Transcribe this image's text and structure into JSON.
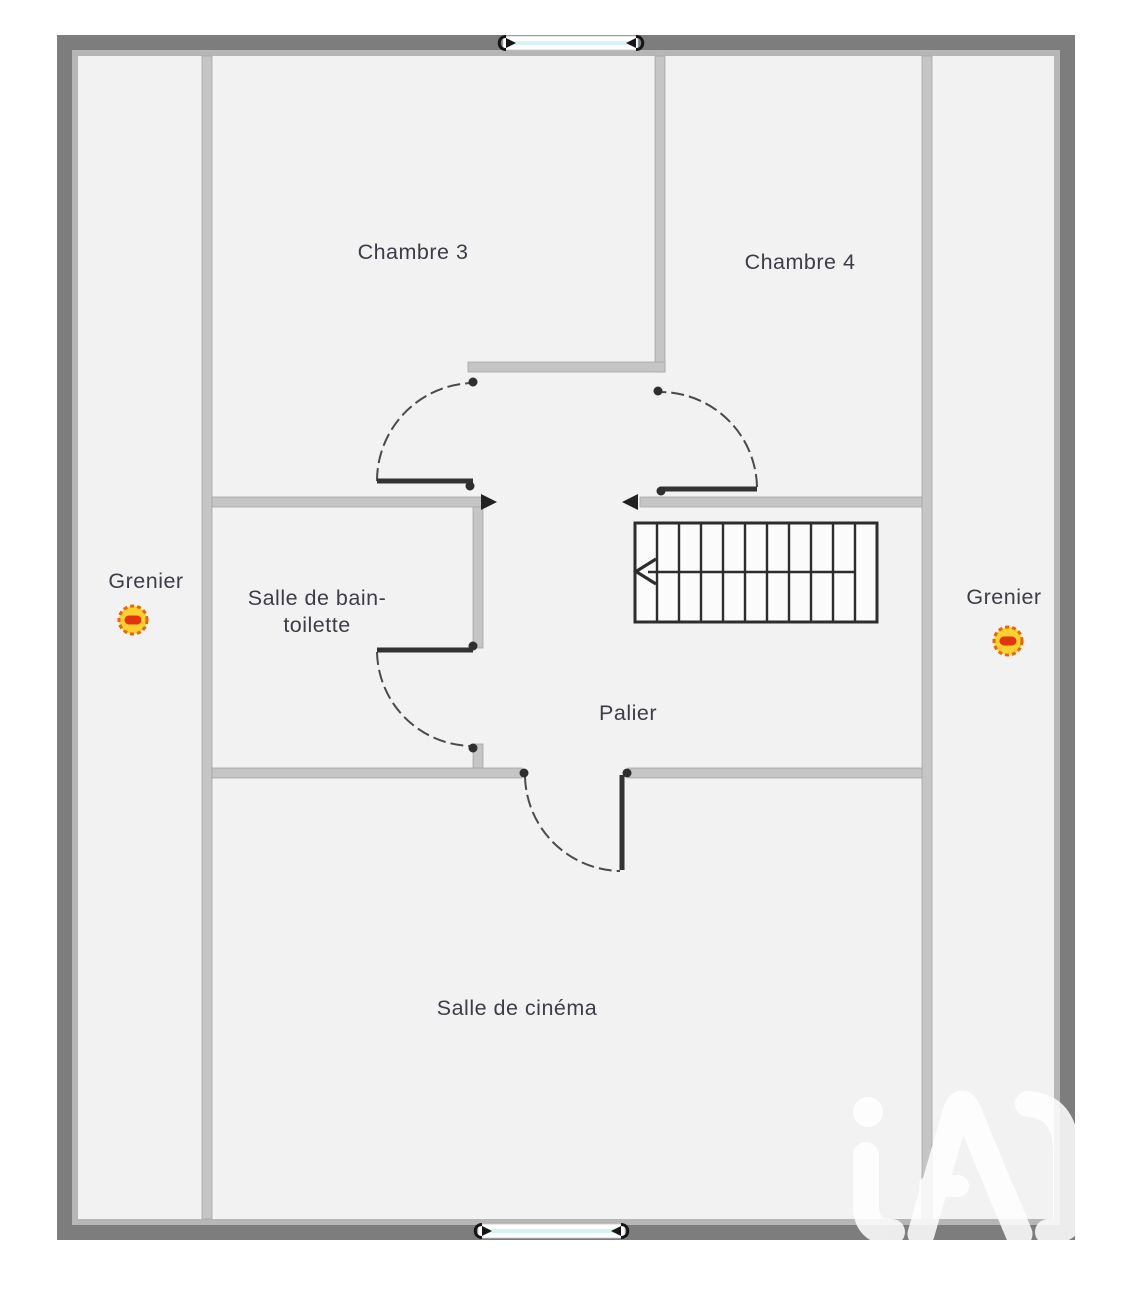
{
  "plan": {
    "title": "Floor plan - upper level",
    "rooms": [
      {
        "id": "chambre3",
        "label": "Chambre 3"
      },
      {
        "id": "chambre4",
        "label": "Chambre 4"
      },
      {
        "id": "bathroom",
        "label_line1": "Salle de bain-",
        "label_line2": "toilette"
      },
      {
        "id": "palier",
        "label": "Palier"
      },
      {
        "id": "cinema",
        "label": "Salle de cinéma"
      },
      {
        "id": "grenier_left",
        "label": "Grenier"
      },
      {
        "id": "grenier_right",
        "label": "Grenier"
      }
    ],
    "icons": [
      {
        "name": "grenier-hatch-icon",
        "count": 2,
        "fill": "#FFD02E",
        "ring": "#E8650A",
        "bar": "#E2350F"
      }
    ],
    "features": {
      "staircase": "stairs with up-direction arrow",
      "windows": 2,
      "doors": 4
    },
    "watermark": {
      "brand": "iad"
    },
    "colors": {
      "outer_wall": "#7d7d7d",
      "wall_lining": "#b6b6b6",
      "interior_wall": "#c5c5c5",
      "floor": "#f2f2f2",
      "label_text": "#3d3d49",
      "window_glass": "#d6f2f5",
      "door_lines": "#3a3a3a"
    }
  }
}
